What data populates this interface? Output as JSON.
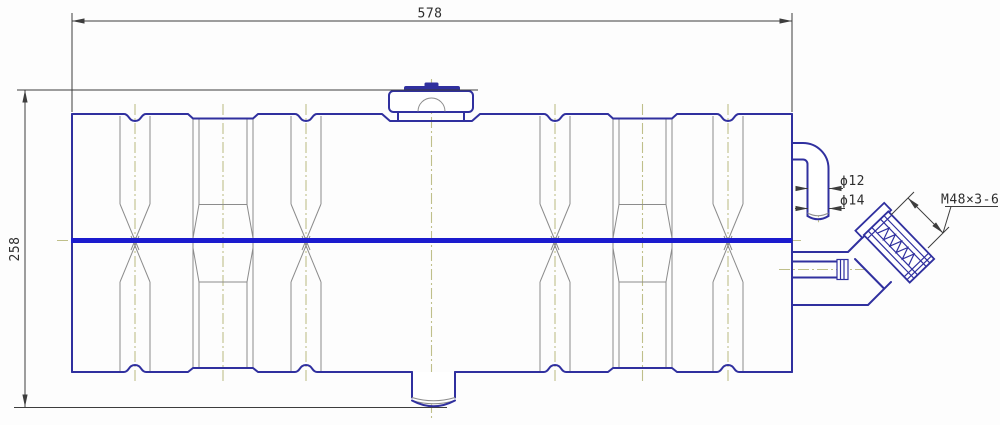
{
  "drawing": {
    "kind": "technical-drawing-tank-side-view",
    "labels": {
      "length": "578",
      "height": "258",
      "dia_small": "ϕ12",
      "dia_large": "ϕ14",
      "thread": "M48×3-6g"
    },
    "colors": {
      "outline": "#30309f",
      "centerline_main": "#1b1bce",
      "centerline_thin": "#bfbf8a",
      "detail": "#8c8c8c",
      "dimension": "#3d3d3d",
      "text": "#2e2e2e",
      "background": "#fdfdfd"
    }
  }
}
